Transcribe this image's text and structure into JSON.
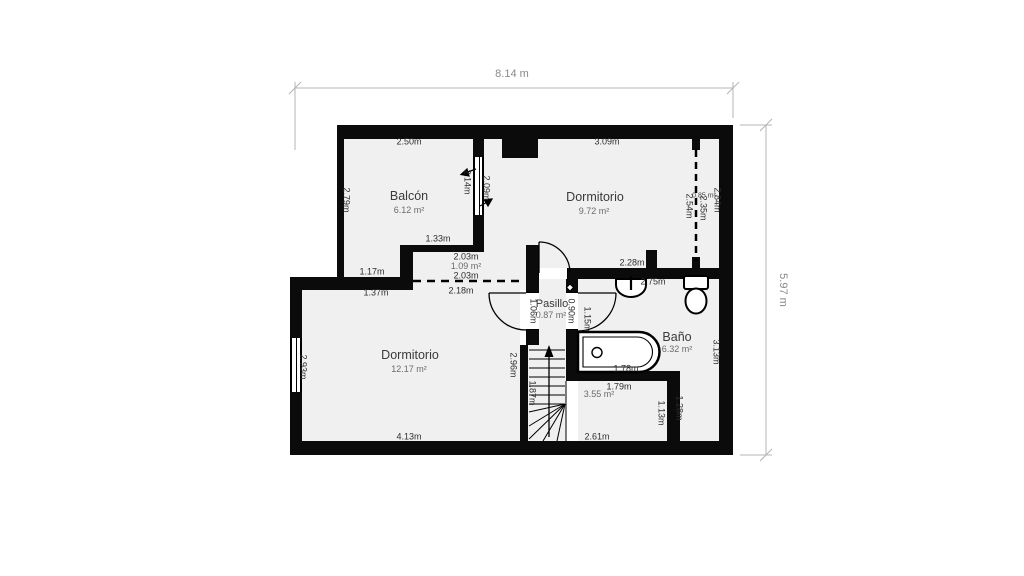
{
  "colors": {
    "wall": "#0b0b0b",
    "room_fill": "#f0f0f0",
    "dimension": "#8a8a8a",
    "background": "#ffffff"
  },
  "icons": [
    "bathtub-icon",
    "toilet-icon",
    "sink-icon",
    "stairs-up-arrow",
    "door-swing-arc",
    "window-glyph",
    "door-diamond"
  ],
  "dimensions": {
    "total_width": "8.14 m",
    "total_height": "5.97 m"
  },
  "rooms": {
    "balcon": {
      "name": "Balcón",
      "area": "6.12 m²"
    },
    "dormitorio_top": {
      "name": "Dormitorio",
      "area": "9.72 m²"
    },
    "dormitorio_bottom": {
      "name": "Dormitorio",
      "area": "12.17 m²"
    },
    "pasillo": {
      "name": "Pasillo",
      "area": "0.87 m²"
    },
    "bano": {
      "name": "Baño",
      "area": "6.32 m²"
    },
    "stair_room": {
      "area": "3.55 m²"
    },
    "closet": {
      "area": "1.09 m²"
    },
    "wardrobe": {
      "area": "0.85 m²"
    }
  },
  "measurements": {
    "balcon_top": "2.50m",
    "balcon_left": "2.79m",
    "balcon_window_out": "2.14m",
    "balcon_window_in": "2.09m",
    "dorm1_top": "3.09m",
    "wardrobe_inner": "2.54m",
    "wardrobe_mid": "2.35m",
    "wardrobe_outer": "2.84m",
    "closet_top": "1.33m",
    "closet_width": "2.03m",
    "closet_opening": "2.03m",
    "closet_opening_below": "2.18m",
    "step_upper": "1.17m",
    "step_lower": "1.37m",
    "dorm2_left": "2.93m",
    "dorm2_right": "2.96m",
    "dorm2_bottom": "4.13m",
    "dorm1_bottom": "2.28m",
    "bano_top": "2.75m",
    "pasillo_door_left": "1.06m",
    "pasillo_door_right": "0.90m",
    "bano_door": "1.15m",
    "bano_right": "3.13m",
    "bathtub_length": "1.78m",
    "stair_room_top": "1.79m",
    "stair_room_bottom": "2.61m",
    "stair_room_right": "1.13m",
    "bano_strip": "1.28m",
    "stairs_run": "1.87m"
  }
}
